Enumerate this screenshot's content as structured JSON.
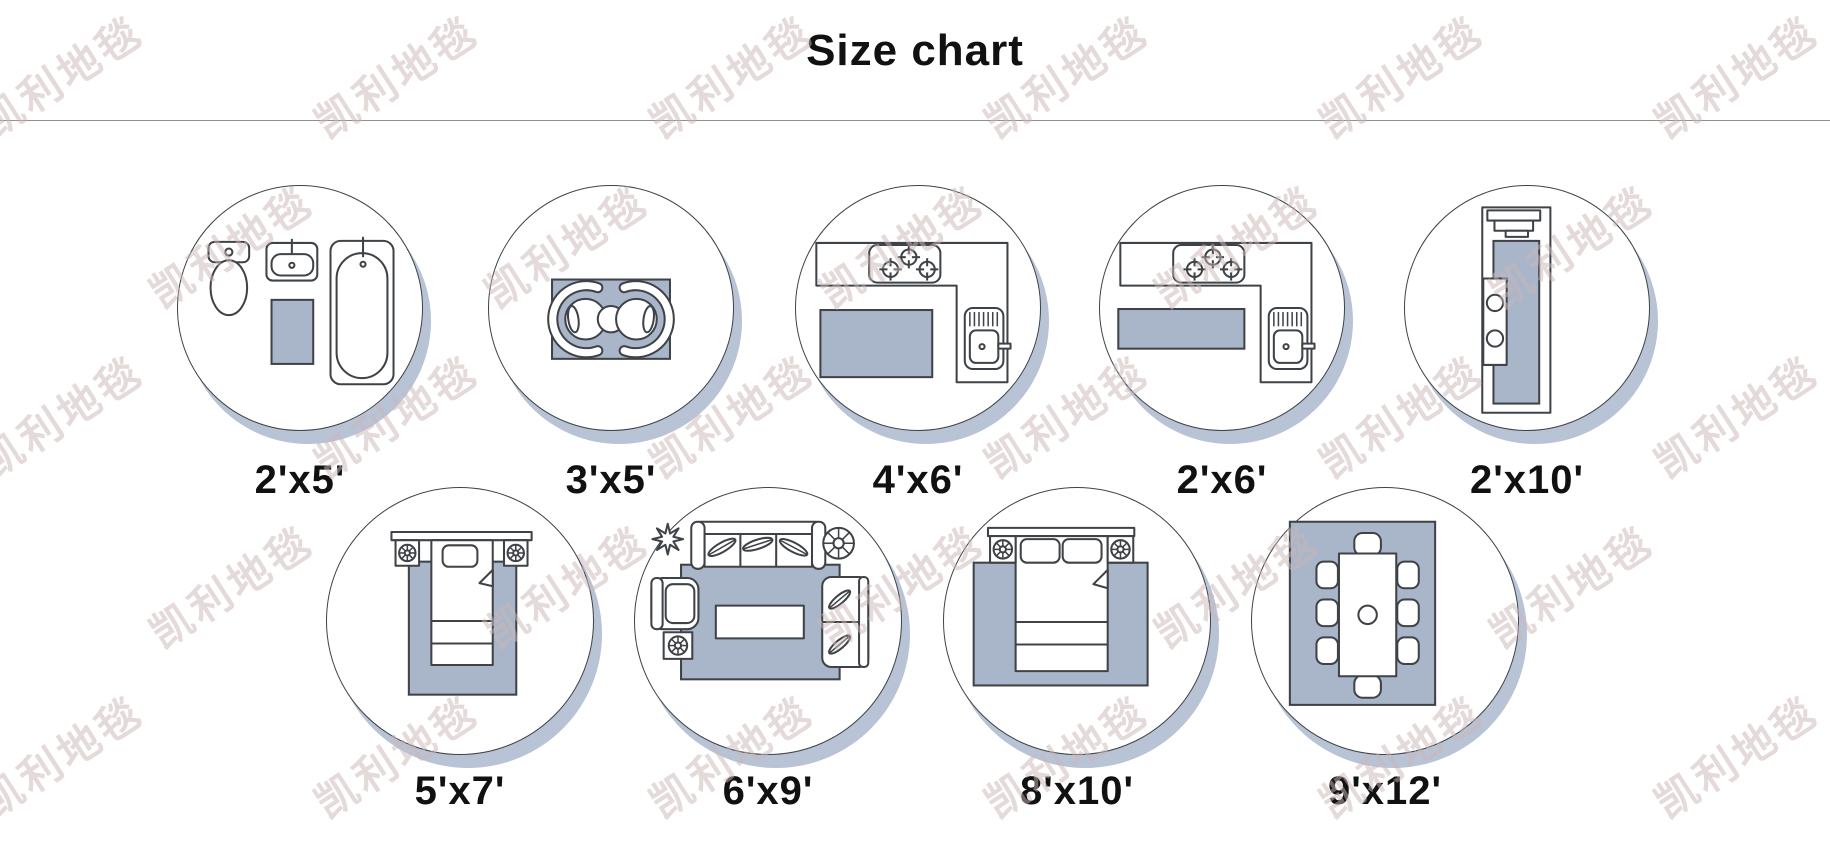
{
  "title": "Size chart",
  "watermark": {
    "text": "凯利地毯",
    "positions": [
      [
        60,
        75
      ],
      [
        395,
        75
      ],
      [
        730,
        75
      ],
      [
        1065,
        75
      ],
      [
        1400,
        75
      ],
      [
        1735,
        75
      ],
      [
        230,
        245
      ],
      [
        565,
        245
      ],
      [
        900,
        245
      ],
      [
        1235,
        245
      ],
      [
        1570,
        245
      ],
      [
        60,
        415
      ],
      [
        395,
        415
      ],
      [
        730,
        415
      ],
      [
        1065,
        415
      ],
      [
        1400,
        415
      ],
      [
        1735,
        415
      ],
      [
        230,
        585
      ],
      [
        565,
        585
      ],
      [
        900,
        585
      ],
      [
        1235,
        585
      ],
      [
        1570,
        585
      ],
      [
        60,
        755
      ],
      [
        395,
        755
      ],
      [
        730,
        755
      ],
      [
        1065,
        755
      ],
      [
        1400,
        755
      ],
      [
        1735,
        755
      ]
    ]
  },
  "colors": {
    "background": "#ffffff",
    "outline": "#3f4347",
    "rug_fill": "#a9b6ca",
    "circle_shadow": "#b8c3d5",
    "text": "#111111",
    "divider": "#8f8f8f",
    "watermark": "#cbb7b7"
  },
  "sizes": [
    {
      "label": "2'x5'",
      "room": "bathroom"
    },
    {
      "label": "3'x5'",
      "room": "sitting-area"
    },
    {
      "label": "4'x6'",
      "room": "kitchen"
    },
    {
      "label": "2'x6'",
      "room": "kitchen-runner"
    },
    {
      "label": "2'x10'",
      "room": "hallway-runner"
    },
    {
      "label": "5'x7'",
      "room": "bedroom-twin"
    },
    {
      "label": "6'x9'",
      "room": "living-room"
    },
    {
      "label": "8'x10'",
      "room": "bedroom-double"
    },
    {
      "label": "9'x12'",
      "room": "dining-room"
    }
  ]
}
